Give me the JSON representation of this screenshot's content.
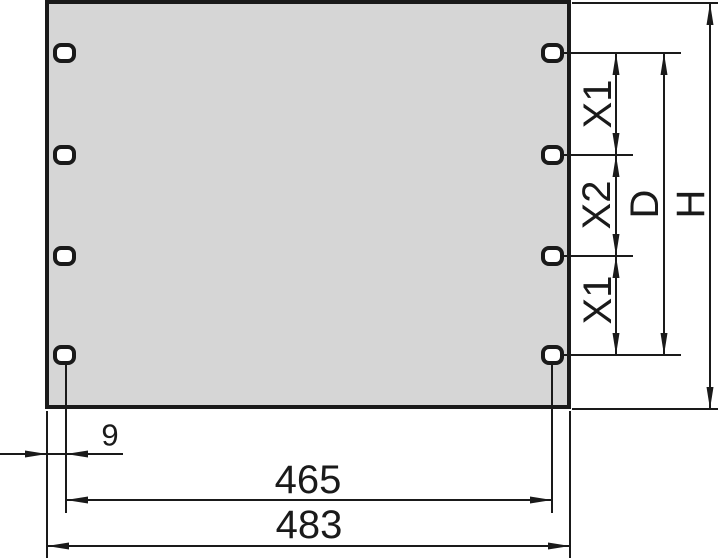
{
  "drawing": {
    "labels": {
      "x1_top": "X1",
      "x2_mid": "X2",
      "x1_bottom": "X1",
      "d": "D",
      "h": "H",
      "edge_offset": "9",
      "hole_span": "465",
      "overall_width": "483"
    },
    "colors": {
      "line": "#1a1a1a",
      "panel_fill": "#d6d6d6",
      "hole_fill": "#ffffff",
      "background": "#ffffff"
    }
  }
}
